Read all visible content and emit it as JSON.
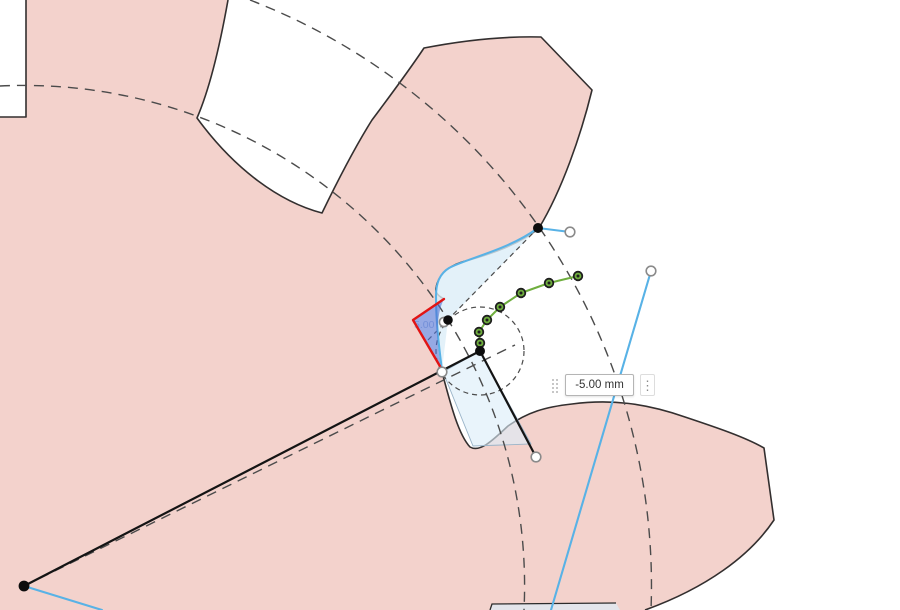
{
  "app": {
    "name": "cad-sketch-canvas"
  },
  "canvas": {
    "background": "#ffffff",
    "gear_fill": "#f3d2cc",
    "gear_outline": "#332f2f",
    "construction_color": "#4b4b4b",
    "curve_blue": "#58b2e6",
    "spline_green": "#6fae3e",
    "highlight_red": "#e11414",
    "selection_fill": "#4f6fd2",
    "profile_fill": "#dcedf8",
    "faint_dim_label": "5.00"
  },
  "dimension_input": {
    "value": "-5.00 mm",
    "grip_icon": "drag-grip",
    "options_icon": "vertical-ellipsis"
  }
}
